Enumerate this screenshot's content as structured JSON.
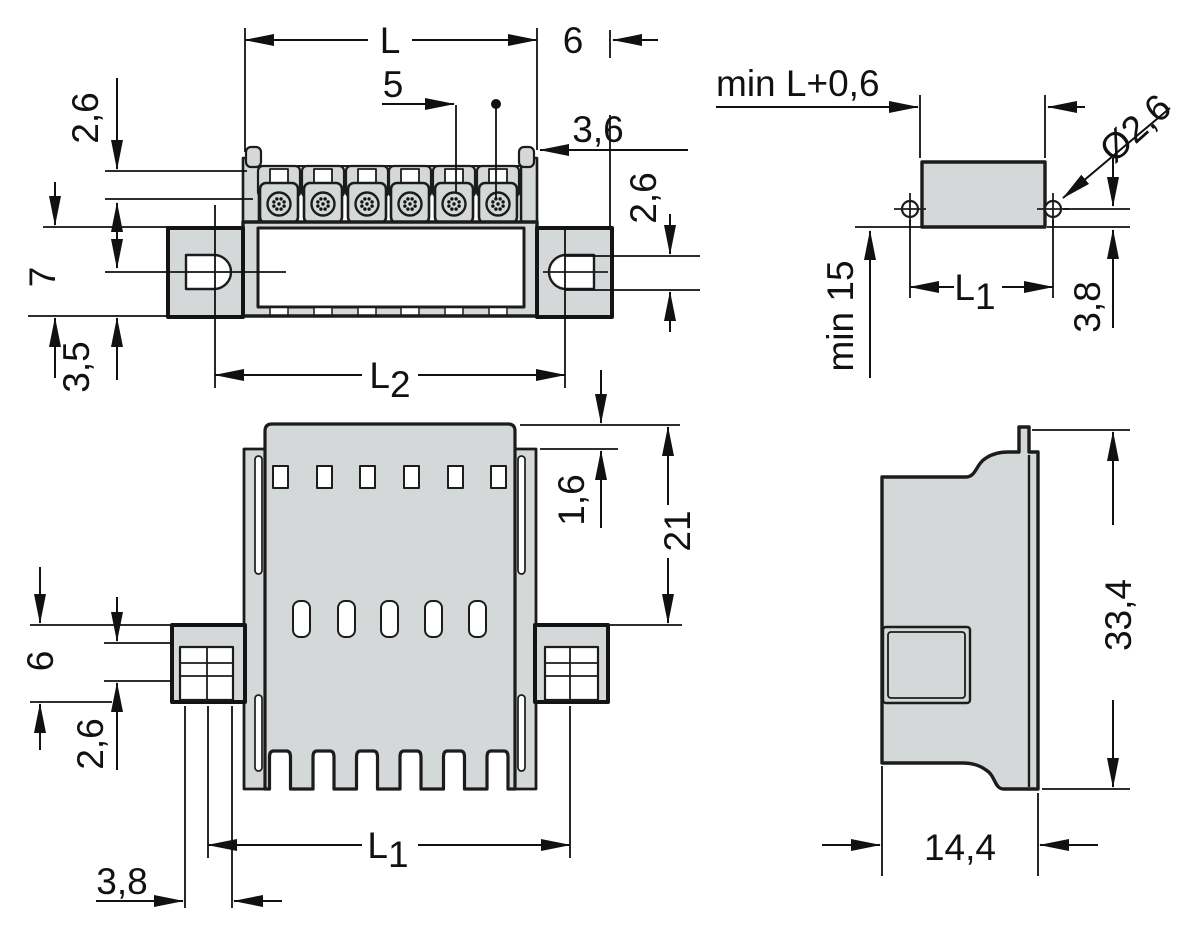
{
  "drawing": {
    "type": "technical-dimension-drawing",
    "poles_visible": 6,
    "colors": {
      "body_fill": "#d5d8d9",
      "line_color": "#1a1a1a",
      "background": "#ffffff"
    },
    "views": {
      "front": {
        "dims": {
          "length": "L",
          "pitch": "5",
          "flange_width": "6",
          "edge_offset": "3,6",
          "clamp_height": "2,6",
          "flange_height": "7",
          "hole_offset": "3,5",
          "slot_width": "2,6",
          "hole_spacing": {
            "base": "L",
            "sub": "2"
          }
        }
      },
      "pcb": {
        "dims": {
          "min_length": "min L+0,6",
          "hole_dia": "Ø2,6",
          "hole_spacing": {
            "base": "L",
            "sub": "1"
          },
          "clearance": "min 15",
          "pin_offset": "3,8"
        }
      },
      "bottom": {
        "dims": {
          "cap_lip": "1,6",
          "body_height": "21",
          "flange_height": "6",
          "pin_height": "2,6",
          "pin_spacing": {
            "base": "L",
            "sub": "1"
          },
          "pin_offset": "3,8"
        }
      },
      "side": {
        "dims": {
          "height": "33,4",
          "depth": "14,4"
        }
      }
    }
  }
}
